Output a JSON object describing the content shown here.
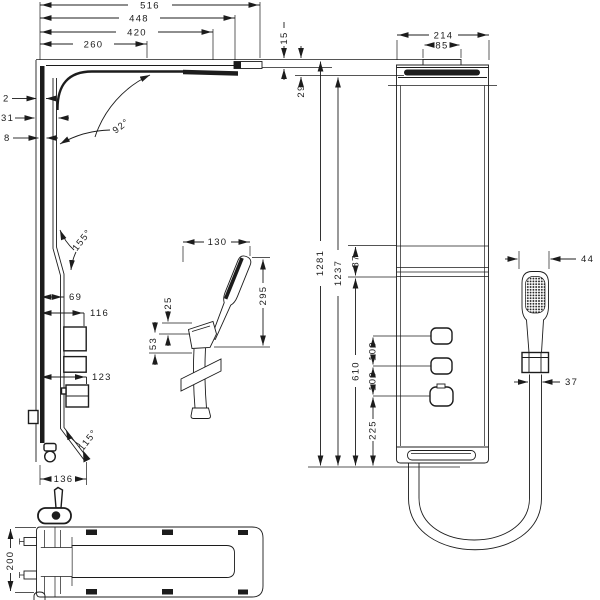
{
  "drawing_type": "shower panel installation dimensions",
  "views": {
    "side": {
      "dim_516": "516",
      "dim_448": "448",
      "dim_420": "420",
      "dim_260": "260",
      "dim_15": "15",
      "dim_29": "29",
      "dim_2": "2",
      "dim_31": "31",
      "dim_8": "8",
      "angle_92": "92°",
      "angle_155": "155°",
      "angle_115": "115°",
      "dim_69": "69",
      "dim_116": "116",
      "dim_123": "123",
      "dim_136": "136"
    },
    "handshower": {
      "dim_130": "130",
      "dim_295": "295",
      "dim_25": "25",
      "dim_53": "53"
    },
    "front": {
      "dim_214": "214",
      "dim_85": "85",
      "dim_1281": "1281",
      "dim_1237": "1237",
      "dim_87": "87",
      "dim_610": "610",
      "dim_100_upper": "100",
      "dim_100_lower": "100",
      "dim_225": "225",
      "dim_44": "44",
      "dim_37": "37"
    },
    "bottom": {
      "dim_200": "200"
    }
  }
}
